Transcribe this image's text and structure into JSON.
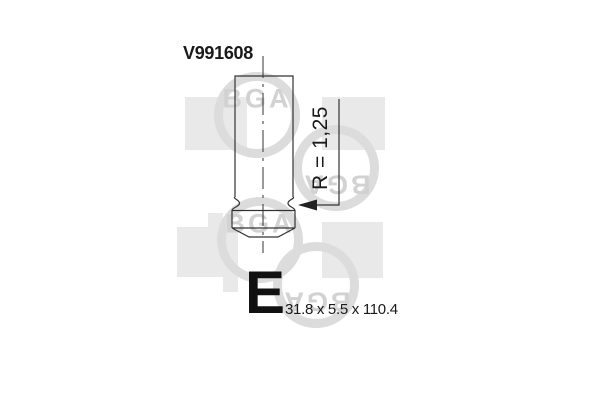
{
  "drawing": {
    "part_number": "V991608",
    "radius_label": "R = 1,25",
    "size_class_letter": "E",
    "dimensions_label": "31.8 x 5.5 x 110.4"
  },
  "watermark": {
    "logo_text": "BGA"
  },
  "colors": {
    "background": "#ffffff",
    "drawing_line": "#333333",
    "label_text": "#1a1a1a",
    "watermark_ring": "#dcdcdc",
    "watermark_text": "#d2d2d2",
    "watermark_square": "#e9e9e9"
  }
}
